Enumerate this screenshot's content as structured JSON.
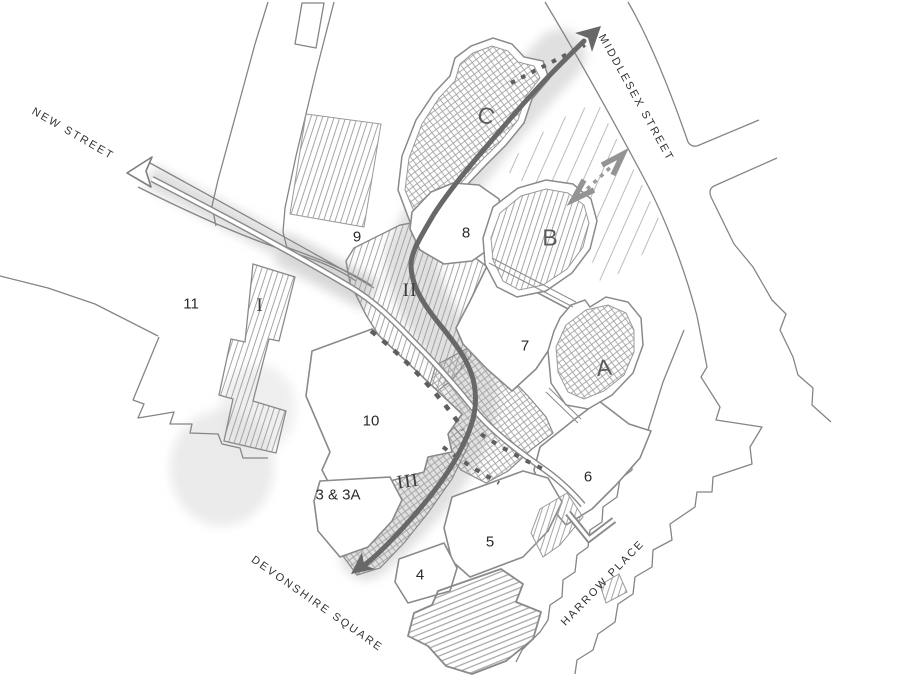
{
  "plan": {
    "streets": {
      "new_street": "NEW STREET",
      "middlesex_street": "MIDDLESEX STREET",
      "harrow_place": "HARROW PLACE",
      "devonshire_square": "DEVONSHIRE SQUARE"
    },
    "buildings": {
      "b3": "3 & 3A",
      "b4": "4",
      "b5": "5",
      "b6": "6",
      "b7": "7",
      "b8": "8",
      "b9": "9",
      "b10": "10",
      "b11": "11"
    },
    "blocks": {
      "a": "A",
      "b": "B",
      "c": "C"
    },
    "phases": {
      "i": "I",
      "ii": "II",
      "iii": "III"
    },
    "symbols": {
      "route_arrow": "main-route-arrow",
      "dashed_arrow": "two-way-dashed-arrow",
      "path_arrow": "pedestrian-path-arrow",
      "street_arrow": "new-street-direction-arrow"
    },
    "colors": {
      "background": "#ffffff",
      "outline": "#8a8a8a",
      "hatch": "#9c9c9c",
      "route_arrow": "#686868",
      "plaza_shade": "#d9d9d9",
      "label_text": "#2e2e2e"
    }
  }
}
